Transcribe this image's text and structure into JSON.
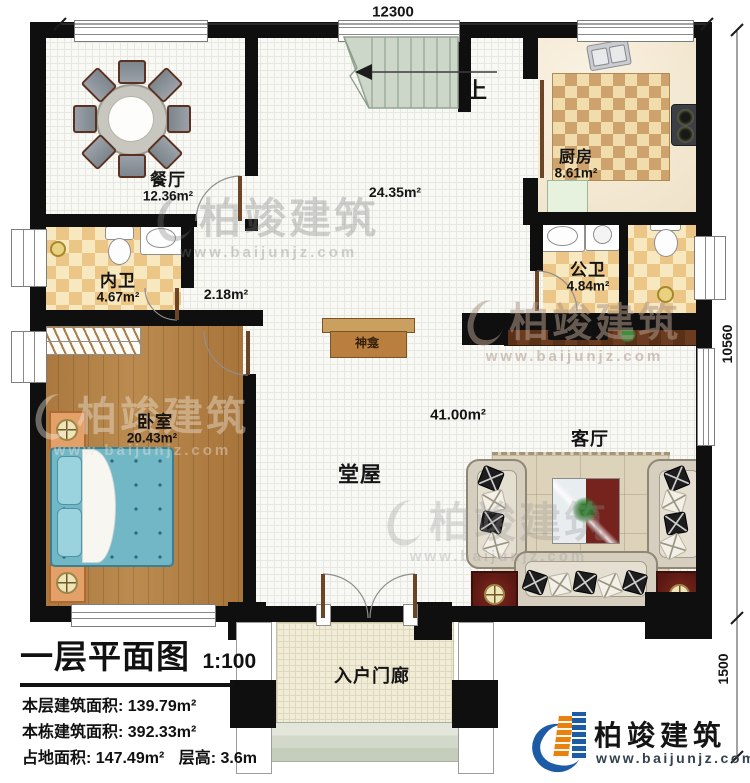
{
  "dimensions": {
    "width": "12300",
    "height_main": "10560",
    "height_porch": "1500"
  },
  "rooms": {
    "dining": {
      "name": "餐厅",
      "area": "12.36m²"
    },
    "kitchen": {
      "name": "厨房",
      "area": "8.61m²"
    },
    "inner_bath": {
      "name": "内卫",
      "area": "4.67m²"
    },
    "public_bath": {
      "name": "公卫",
      "area": "4.84m²"
    },
    "bedroom": {
      "name": "卧室",
      "area": "20.43m²"
    },
    "hall": {
      "name": "堂屋",
      "area": "41.00m²"
    },
    "stair_hall": {
      "area": "24.35m²"
    },
    "corridor": {
      "area": "2.18m²"
    },
    "living": {
      "name": "客厅"
    },
    "porch": {
      "name": "入户门廊"
    }
  },
  "features": {
    "shrine": "神龛",
    "stairs_up": "上"
  },
  "title_block": {
    "title": "一层平面图",
    "scale": "1:100",
    "floor_area": "本层建筑面积: 139.79m²",
    "building_area": "本栋建筑面积: 392.33m²",
    "land_area": "占地面积: 147.49m²",
    "floor_height": "层高: 3.6m"
  },
  "branding": {
    "company": "柏竣建筑",
    "website": "www.baijunjz.com"
  },
  "colors": {
    "wall": "#0f0f0f",
    "wood_floor": "#ad7b41",
    "bath_tile": "#ecc687",
    "stairs": "#ccd7ca",
    "bed": "#72b7c6",
    "brand_blue": "#1d5ca5",
    "brand_orange": "#e8820c",
    "dark_red_table": "#6e211b"
  }
}
